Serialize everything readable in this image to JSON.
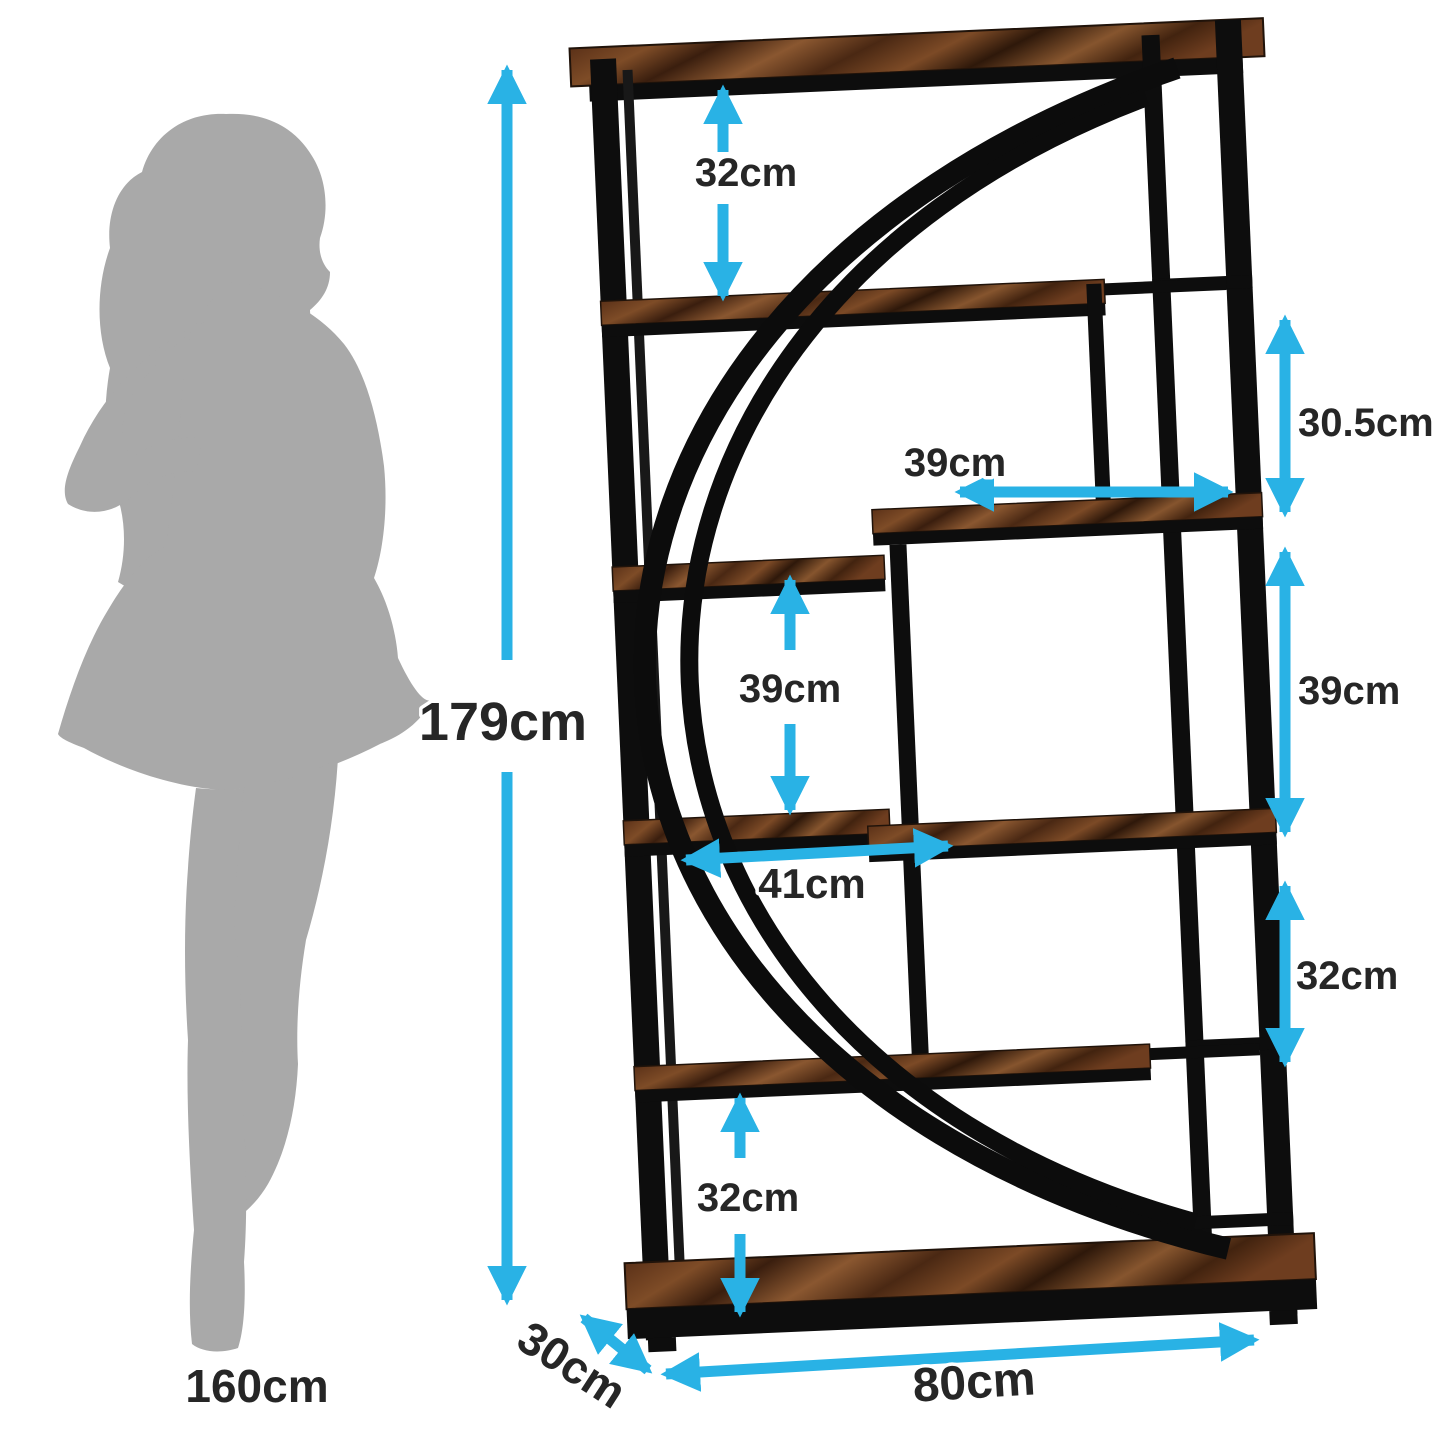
{
  "image": {
    "type": "product-dimension-diagram",
    "background": "#ffffff"
  },
  "palette": {
    "arrow_blue": "#29b2e5",
    "label_text": "#262626",
    "silhouette_gray": "#a9a9a9",
    "metal_black": "#0d0d0d",
    "wood_brown_dark": "#3a1e0e",
    "wood_brown_mid": "#7c4a26",
    "wood_brown_light": "#8a5730"
  },
  "reference_figure": {
    "description": "woman silhouette for scale",
    "height_label": "160cm"
  },
  "bookshelf": {
    "style": "industrial etagere, black metal frame, rustic brown wood shelves, double crescent arc",
    "overall": {
      "height_label": "179cm",
      "width_label": "80cm",
      "depth_label": "30cm"
    },
    "internal": [
      {
        "id": "top-gap-height",
        "label": "32cm"
      },
      {
        "id": "upper-right-box-height",
        "label": "30.5cm"
      },
      {
        "id": "upper-right-shelf-width",
        "label": "39cm"
      },
      {
        "id": "middle-left-gap-height",
        "label": "39cm"
      },
      {
        "id": "middle-right-cube-height",
        "label": "39cm"
      },
      {
        "id": "middle-left-shelf-width",
        "label": "41cm"
      },
      {
        "id": "lower-right-gap-height",
        "label": "32cm"
      },
      {
        "id": "bottom-left-gap-height",
        "label": "32cm"
      }
    ]
  }
}
